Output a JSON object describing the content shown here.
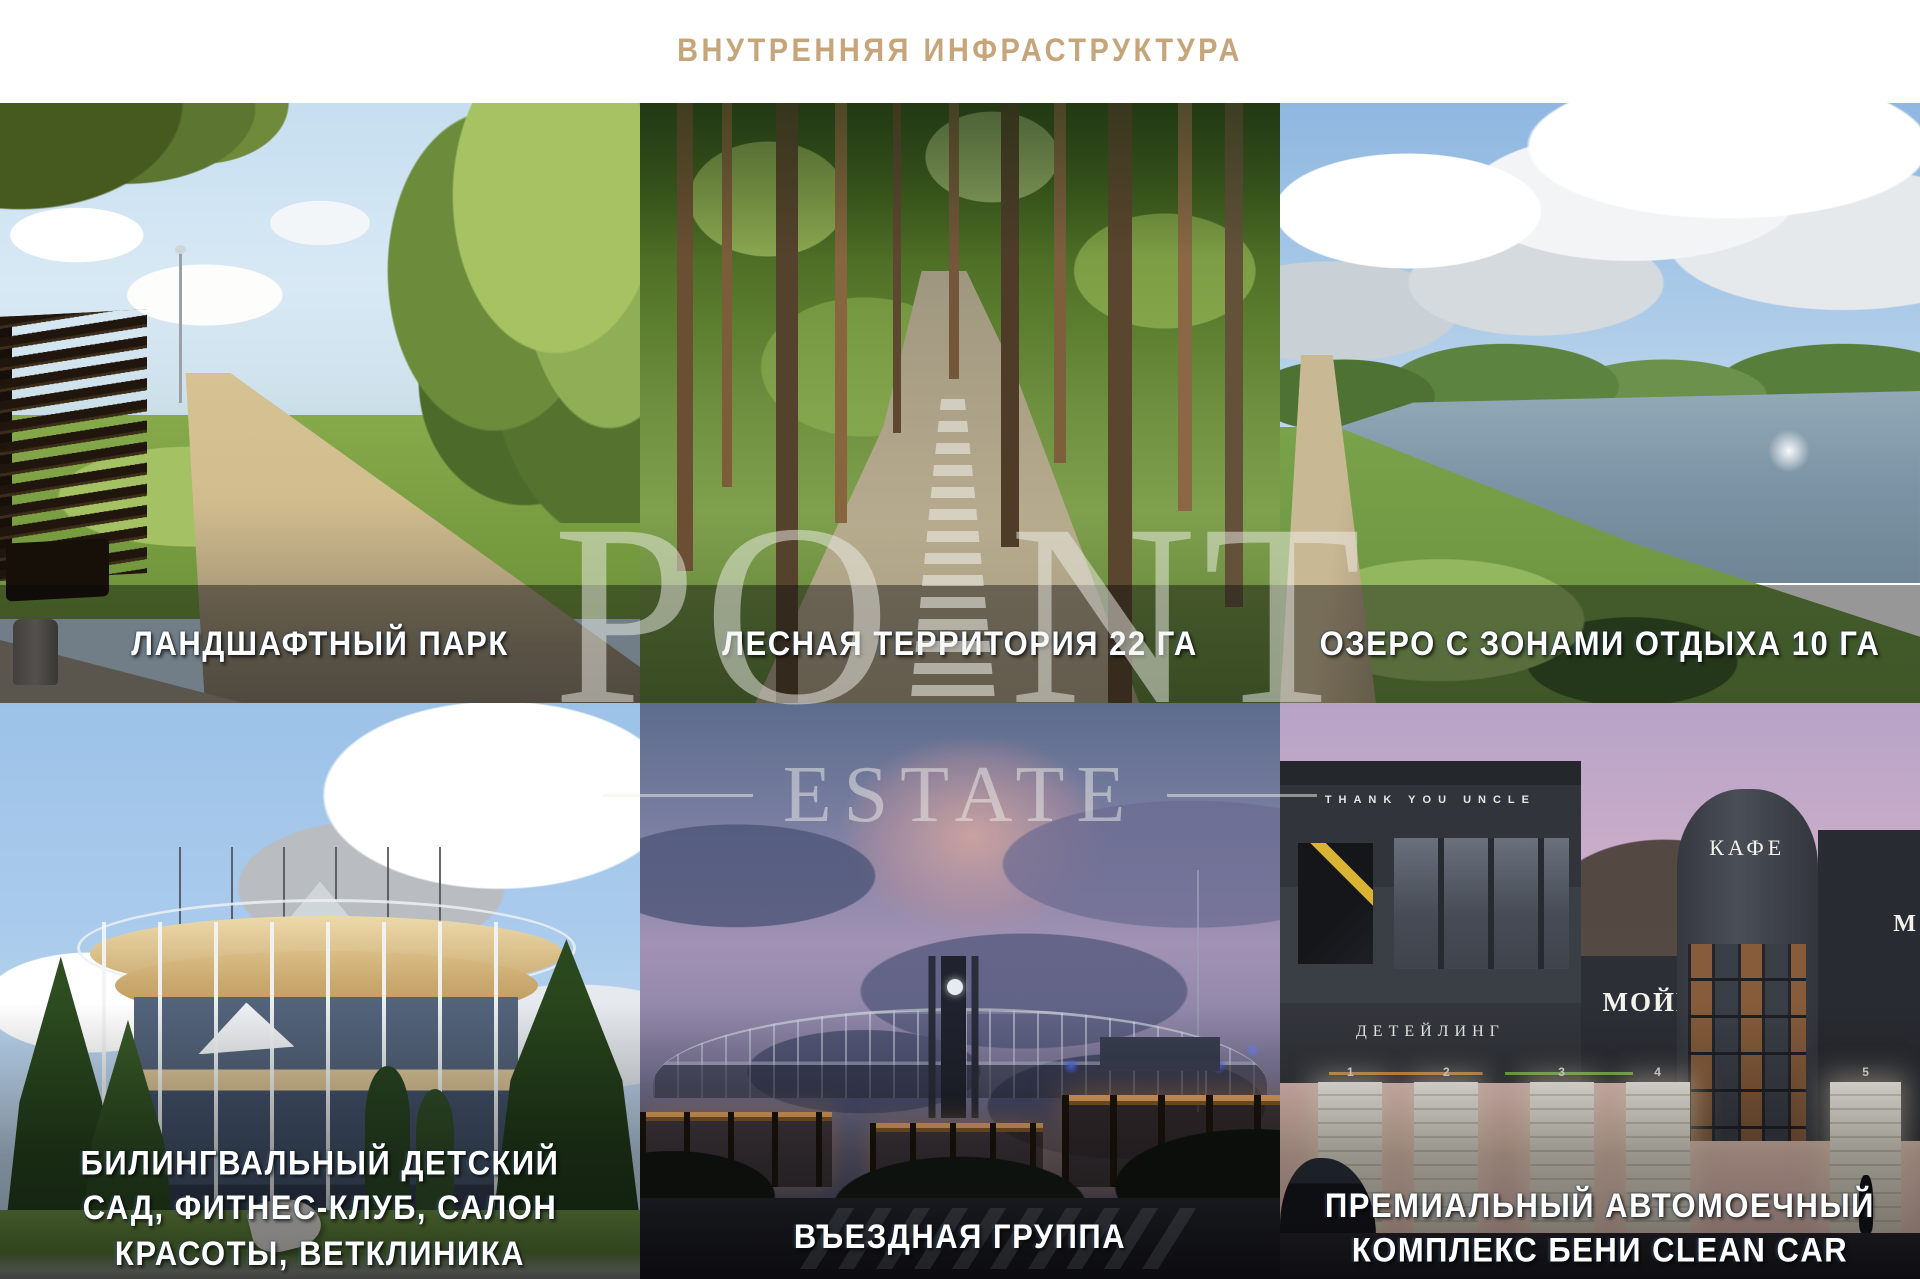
{
  "header": {
    "title": "ВНУТРЕННЯЯ ИНФРАСТРУКТУРА"
  },
  "colors": {
    "title_accent": "#c7a57a",
    "caption_text": "#ffffff",
    "caption_band": "rgba(6,7,10,0.42)"
  },
  "watermark": {
    "po": "PO",
    "nt": "NT",
    "estate": "ESTATE"
  },
  "tiles": [
    {
      "id": "landscape-park",
      "caption": "ЛАНДШАФТНЫЙ ПАРК"
    },
    {
      "id": "forest-territory",
      "caption": "ЛЕСНАЯ ТЕРРИТОРИЯ 22 ГА"
    },
    {
      "id": "lake-rest-zones",
      "caption": "ОЗЕРО С ЗОНАМИ ОТДЫХА 10 ГА"
    },
    {
      "id": "kindergarten",
      "caption": "БИЛИНГВАЛЬНЫЙ ДЕТСКИЙ САД, ФИТНЕС-КЛУБ, САЛОН КРАСОТЫ, ВЕТКЛИНИКА"
    },
    {
      "id": "entrance-group",
      "caption": "ВЪЕЗДНАЯ ГРУППА"
    },
    {
      "id": "car-wash",
      "caption": "ПРЕМИАЛЬНЫЙ АВТОМОЕЧНЫЙ КОМПЛЕКС БЕНИ CLEAN CAR"
    }
  ],
  "car_wash": {
    "roof_sign": "THANK YOU UNCLE",
    "detailing_sign": "ДЕТЕЙЛИНГ",
    "wash_sign": "МОЙКА",
    "cafe_sign": "КАФЕ",
    "right_sign": "М",
    "bays": [
      "1",
      "2",
      "3",
      "4",
      "5"
    ]
  }
}
